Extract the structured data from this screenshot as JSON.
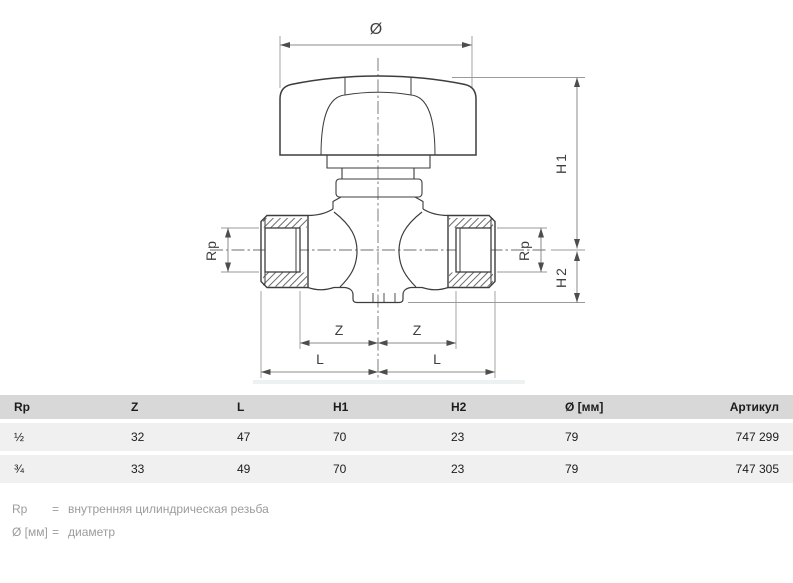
{
  "drawing": {
    "diameter": "Ø",
    "h1": "H1",
    "h2": "H2",
    "rp_left": "Rp",
    "rp_right": "Rp",
    "z_left": "Z",
    "z_right": "Z",
    "l_left": "L",
    "l_right": "L"
  },
  "table": {
    "headers": [
      "Rp",
      "Z",
      "L",
      "H1",
      "H2",
      "Ø [мм]",
      "Артикул"
    ],
    "rows": [
      {
        "rp": "½",
        "z": "32",
        "l": "47",
        "h1": "70",
        "h2": "23",
        "d": "79",
        "article": "747 299"
      },
      {
        "rp": "¾",
        "z": "33",
        "l": "49",
        "h1": "70",
        "h2": "23",
        "d": "79",
        "article": "747 305"
      }
    ]
  },
  "legend": [
    {
      "symbol": "Rp",
      "eq": "=",
      "text": "внутренняя цилиндрическая резьба"
    },
    {
      "symbol": "Ø [мм]",
      "eq": "=",
      "text": "диаметр"
    }
  ],
  "colors": {
    "table_header_bg": "#d8d8d8",
    "table_row_bg": "#f0f0f0",
    "outline": "#3d3d3d",
    "dimension_line": "#8b8b8b",
    "arrow": "#4d4d4d",
    "legend_text": "#9c9c9c"
  }
}
